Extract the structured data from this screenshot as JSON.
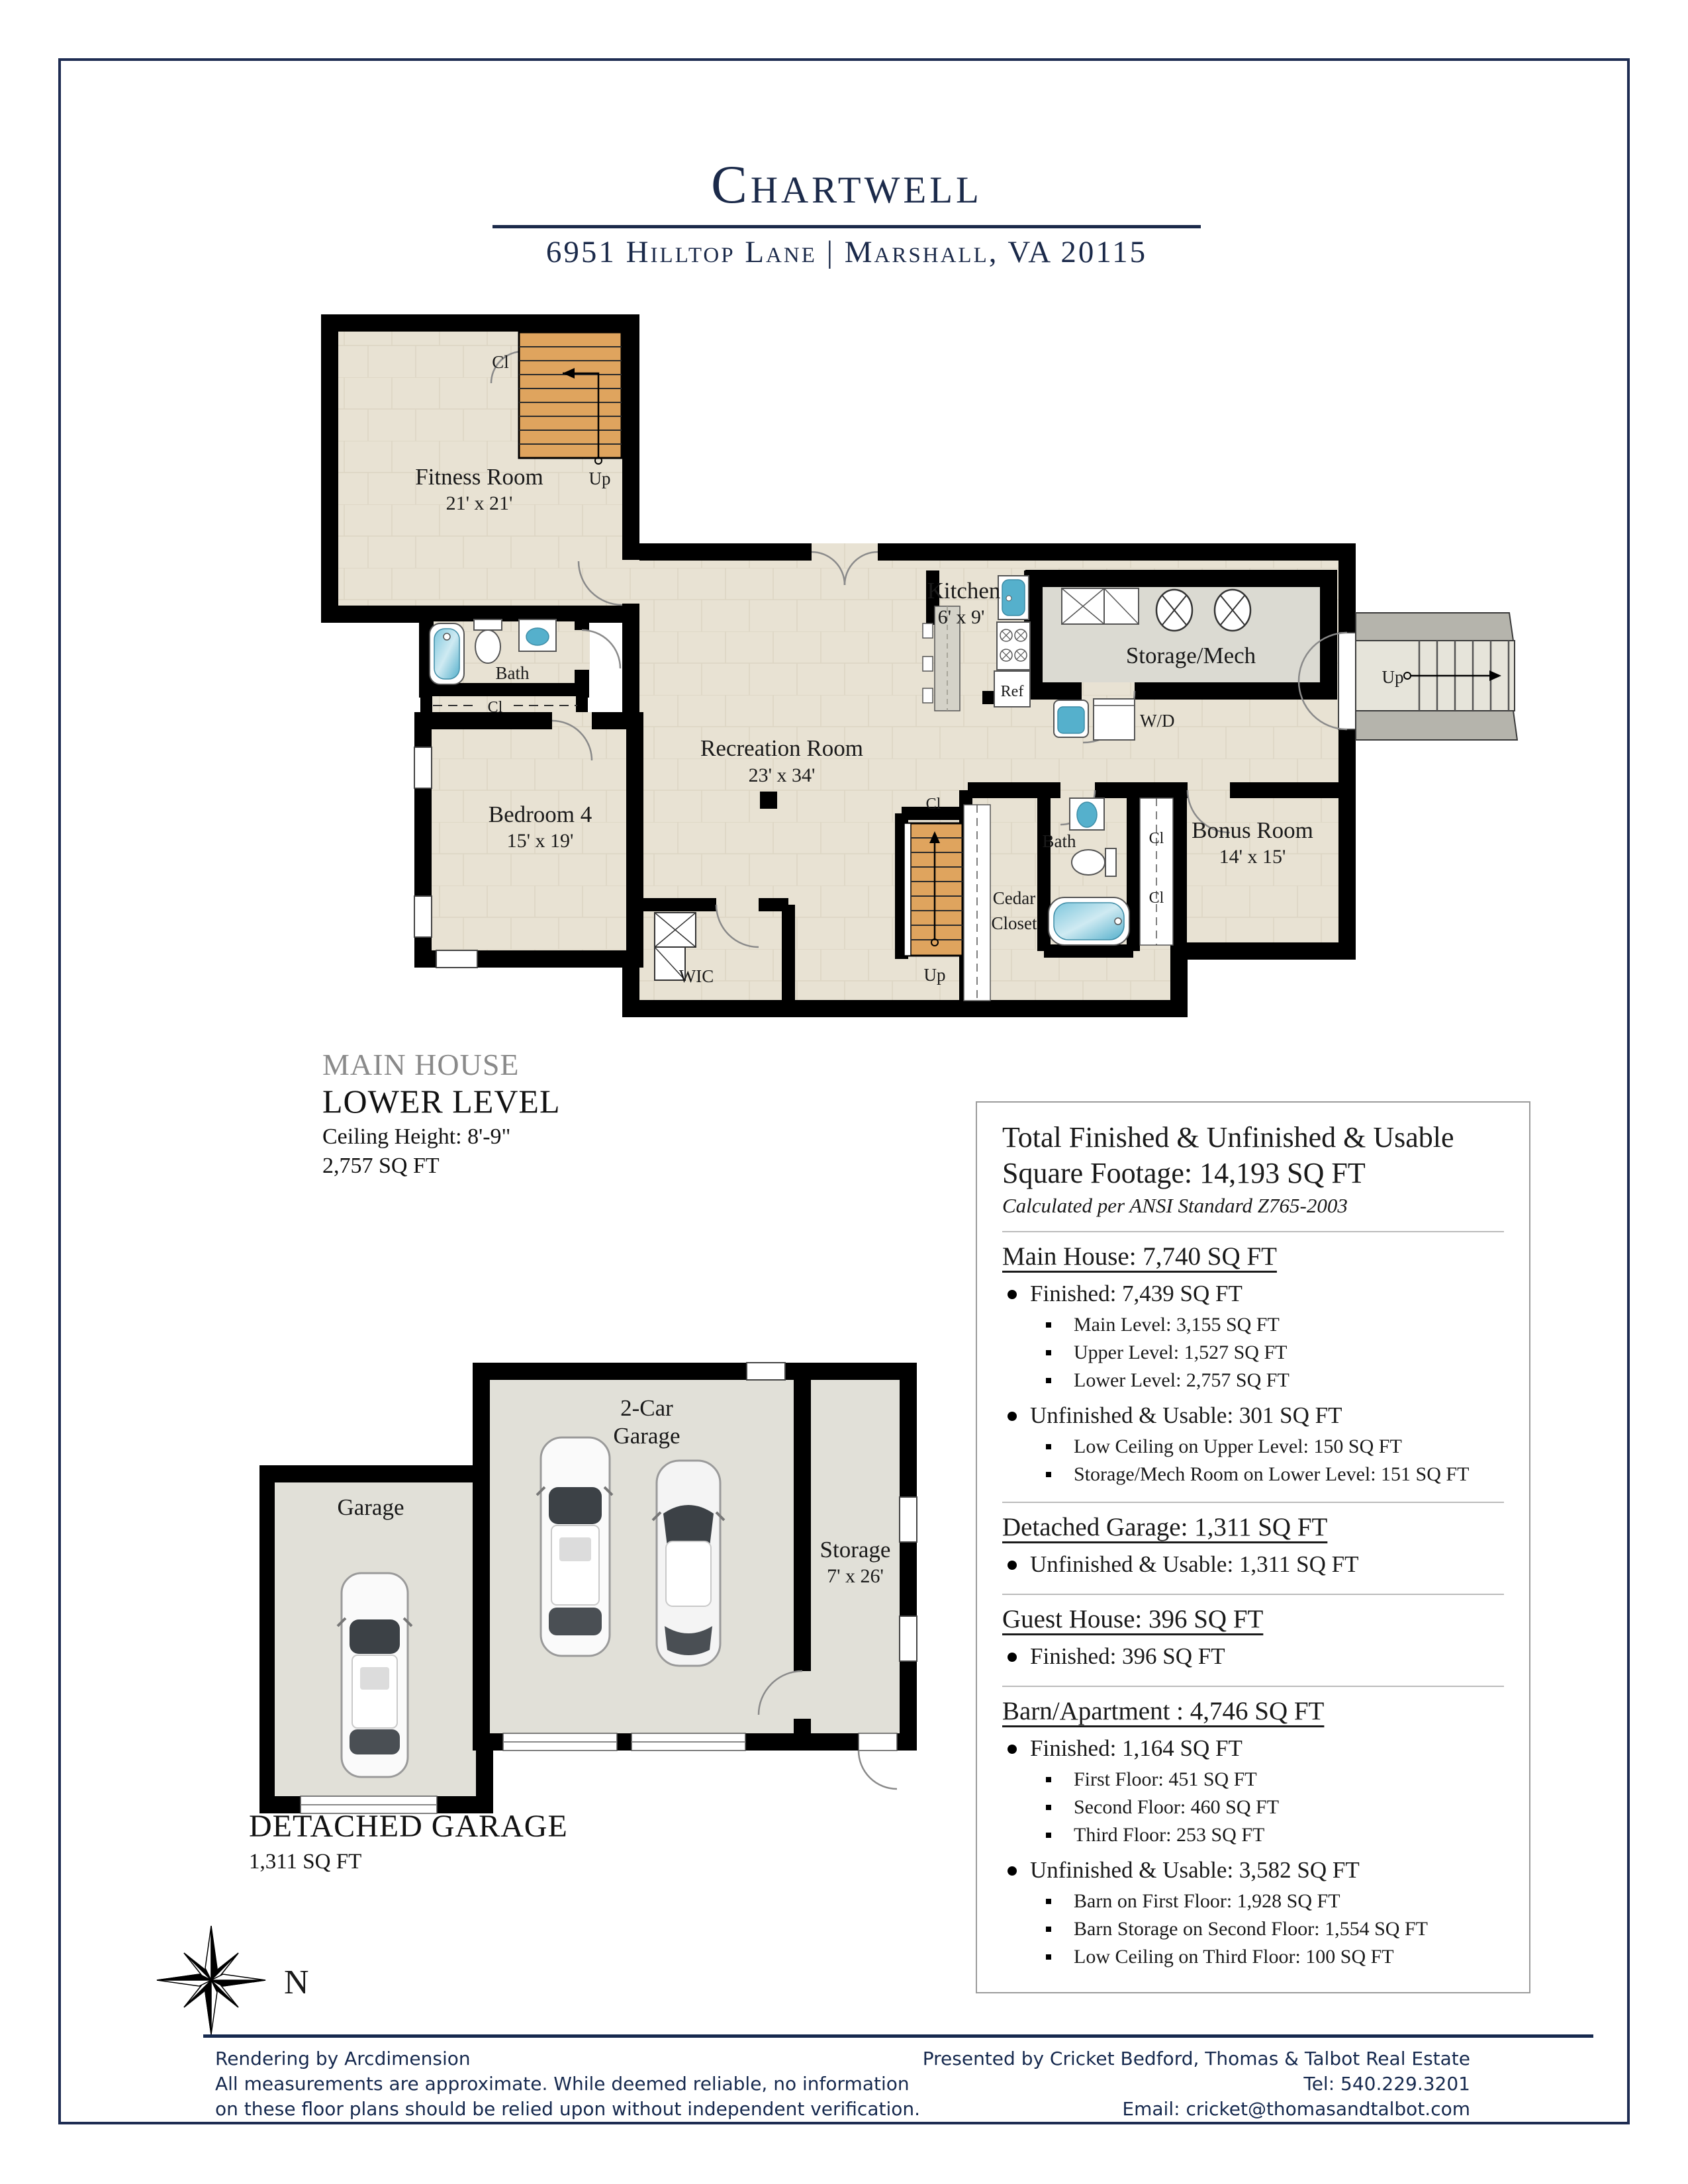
{
  "header": {
    "title": "Chartwell",
    "address": "6951 Hilltop Lane | Marshall, VA 20115"
  },
  "plan1": {
    "caption": {
      "line1": "MAIN HOUSE",
      "line2": "LOWER LEVEL",
      "ceiling": "Ceiling Height: 8'-9\"",
      "area": "2,757 SQ FT"
    },
    "labels": {
      "fitness": "Fitness Room",
      "fitness_dim": "21' x 21'",
      "cl_stair_top": "Cl",
      "up_fitness": "Up",
      "bath1": "Bath",
      "cl_bath1": "Cl",
      "bedroom": "Bedroom 4",
      "bedroom_dim": "15' x 19'",
      "recreation": "Recreation Room",
      "recreation_dim": "23' x 34'",
      "kitchen": "Kitchen",
      "kitchen_dim": "6' x 9'",
      "ref": "Ref",
      "storage_mech": "Storage/Mech",
      "wd": "W/D",
      "cl_center": "Cl",
      "up_center": "Up",
      "cedar_line1": "Cedar",
      "cedar_line2": "Closet",
      "bath2": "Bath",
      "cl_right1": "Cl",
      "cl_right2": "Cl",
      "bonus": "Bonus Room",
      "bonus_dim": "14' x 15'",
      "wic": "WIC",
      "up_exterior": "Up"
    }
  },
  "plan2": {
    "labels": {
      "garage": "Garage",
      "two_car_line1": "2-Car",
      "two_car_line2": "Garage",
      "storage": "Storage",
      "storage_dim": "7' x 26'"
    },
    "caption": {
      "title": "DETACHED GARAGE",
      "area": "1,311 SQ FT"
    }
  },
  "summary": {
    "title_line1": "Total Finished & Unfinished & Usable",
    "title_line2": "Square Footage: 14,193 SQ FT",
    "note": "Calculated per ANSI Standard Z765-2003",
    "sections": [
      {
        "heading": "Main House: 7,740 SQ FT",
        "groups": [
          {
            "bullet": "Finished: 7,439 SQ FT",
            "subs": [
              "Main Level: 3,155 SQ FT",
              "Upper Level: 1,527 SQ FT",
              "Lower Level: 2,757 SQ FT"
            ]
          },
          {
            "bullet": "Unfinished & Usable: 301 SQ FT",
            "subs": [
              "Low Ceiling on Upper Level: 150 SQ FT",
              "Storage/Mech Room on Lower Level: 151 SQ FT"
            ]
          }
        ]
      },
      {
        "heading": "Detached Garage: 1,311 SQ FT",
        "groups": [
          {
            "bullet": "Unfinished & Usable: 1,311 SQ FT",
            "subs": []
          }
        ]
      },
      {
        "heading": "Guest House: 396 SQ FT",
        "groups": [
          {
            "bullet": "Finished: 396 SQ FT",
            "subs": []
          }
        ]
      },
      {
        "heading": "Barn/Apartment : 4,746 SQ FT",
        "groups": [
          {
            "bullet": "Finished: 1,164 SQ FT",
            "subs": [
              "First Floor: 451 SQ FT",
              "Second Floor: 460 SQ FT",
              "Third Floor: 253 SQ FT"
            ]
          },
          {
            "bullet": "Unfinished & Usable: 3,582 SQ FT",
            "subs": [
              "Barn on First Floor: 1,928 SQ FT",
              "Barn Storage on Second Floor: 1,554 SQ FT",
              "Low Ceiling on Third Floor: 100 SQ FT"
            ]
          }
        ]
      }
    ]
  },
  "compass": {
    "label": "N"
  },
  "footer": {
    "left1": "Rendering by Arcdimension",
    "left2": "All measurements are approximate. While deemed reliable, no information",
    "left3": "on these floor plans should be relied upon without independent verification.",
    "right1": "Presented by Cricket Bedford, Thomas & Talbot Real Estate",
    "right2": "Tel: 540.229.3201",
    "right3": "Email: cricket@thomasandtalbot.com"
  },
  "colors": {
    "accent_navy": "#1b2a4a",
    "footer_navy": "#16294e",
    "floor_beige": "#e8e2d3",
    "floor_gray": "#dbdad2",
    "stair_wood": "#dfa45e",
    "fixture_blue": "#55b0cc",
    "wall_black": "#000000"
  }
}
